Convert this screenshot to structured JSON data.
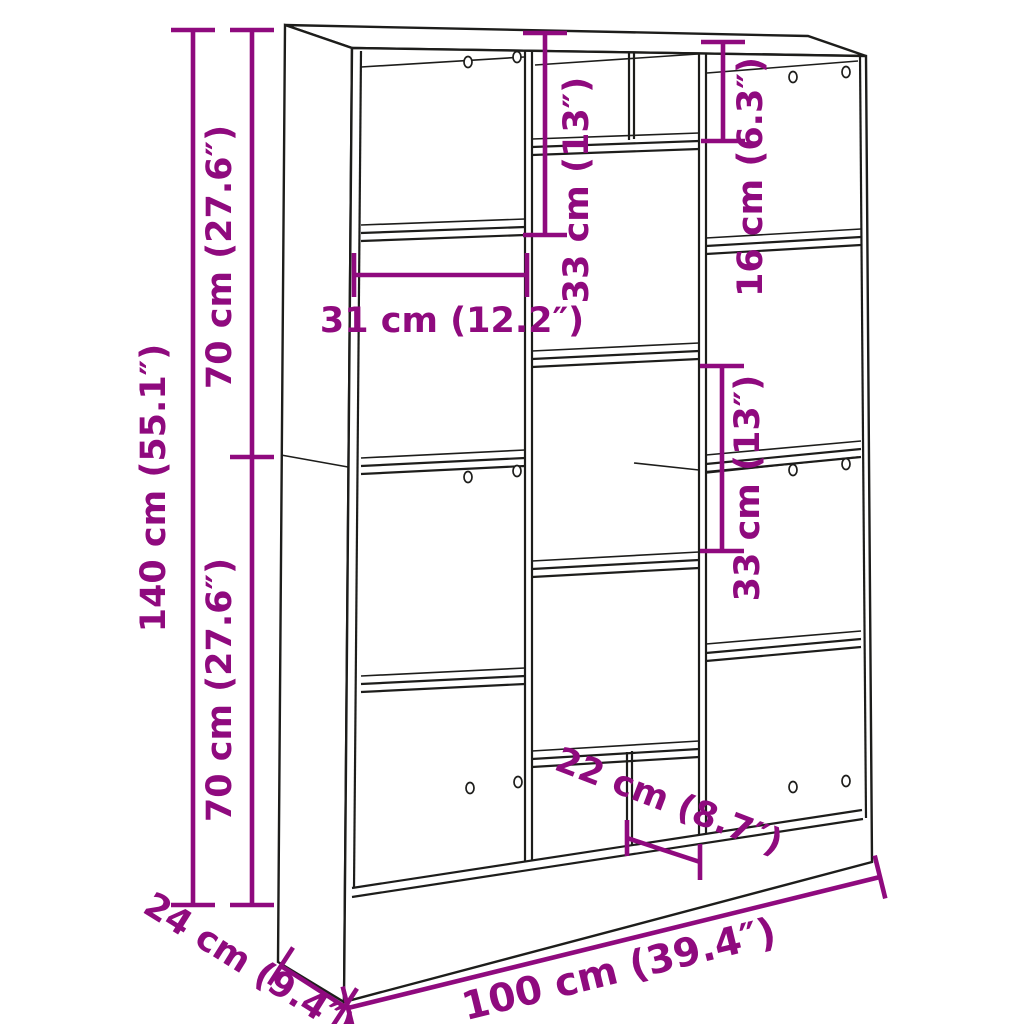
{
  "page": {
    "background": "#ffffff",
    "type": "product-dimension-diagram",
    "product": "bookcase-room-divider"
  },
  "colors": {
    "dimension": "#8f0a7e",
    "line_art": "#1d1d1b"
  },
  "dims": {
    "height_total": {
      "label": "140 cm (55.1″)",
      "cm": 140,
      "in": 55.1
    },
    "height_upper": {
      "label": "70 cm (27.6″)",
      "cm": 70,
      "in": 27.6
    },
    "height_lower": {
      "label": "70 cm (27.6″)",
      "cm": 70,
      "in": 27.6
    },
    "top_compartment_height": {
      "label": "33 cm (13″)",
      "cm": 33,
      "in": 13
    },
    "top_right_cubby_height": {
      "label": "16 cm (6.3″)",
      "cm": 16,
      "in": 6.3
    },
    "left_compartment_width": {
      "label": "31 cm (12.2″)",
      "cm": 31,
      "in": 12.2
    },
    "middle_compartment_height": {
      "label": "33 cm (13″)",
      "cm": 33,
      "in": 13
    },
    "bottom_cubby_width": {
      "label": "22 cm (8.7″)",
      "cm": 22,
      "in": 8.7
    },
    "width_total": {
      "label": "100 cm (39.4″)",
      "cm": 100,
      "in": 39.4
    },
    "depth_total": {
      "label": "24 cm (9.4″)",
      "cm": 24,
      "in": 9.4
    }
  }
}
